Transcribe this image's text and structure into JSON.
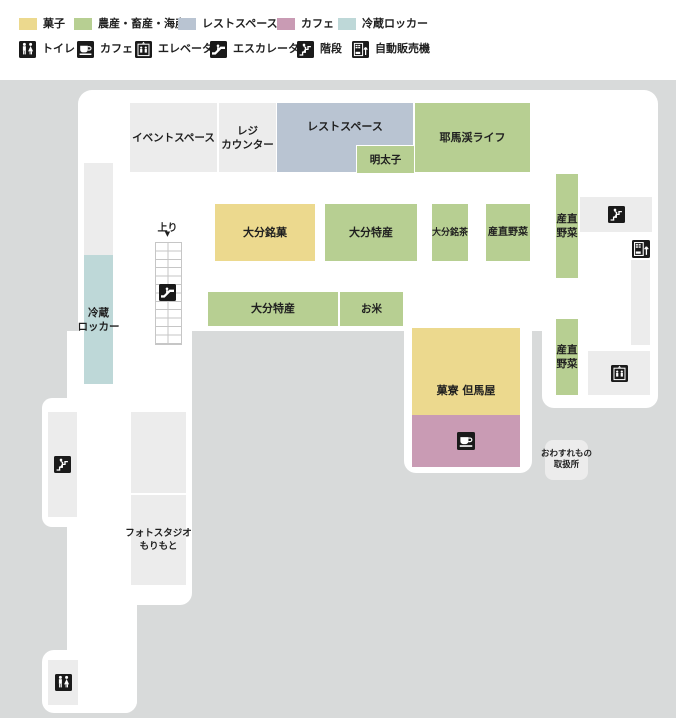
{
  "colors": {
    "bg_gray": "#d8dada",
    "floor_white": "#ffffff",
    "box_light": "#ececec",
    "sweets_yellow": "#ecd98e",
    "produce_green": "#b7cf92",
    "rest_blue": "#b9c4d2",
    "cafe_pink": "#c99bb4",
    "locker_teal": "#bed8d8",
    "icon_black": "#1a1a1a",
    "text": "#1f1f1f"
  },
  "legend": {
    "categories": [
      {
        "label": "菓子",
        "color": "sweets_yellow"
      },
      {
        "label": "農産・畜産・海産",
        "color": "produce_green"
      },
      {
        "label": "レストスペース",
        "color": "rest_blue"
      },
      {
        "label": "カフェ",
        "color": "cafe_pink"
      },
      {
        "label": "冷蔵ロッカー",
        "color": "locker_teal"
      }
    ],
    "facilities": [
      {
        "label": "トイレ",
        "icon": "toilet-icon"
      },
      {
        "label": "カフェ",
        "icon": "cafe-icon"
      },
      {
        "label": "エレベータ",
        "icon": "elevator-icon"
      },
      {
        "label": "エスカレータ",
        "icon": "escalator-icon"
      },
      {
        "label": "階段",
        "icon": "stairs-icon"
      },
      {
        "label": "自動販売機",
        "icon": "vending-icon"
      }
    ]
  },
  "map": {
    "booths": [
      {
        "id": "event-space",
        "label": "イベントスペース"
      },
      {
        "id": "register-counter",
        "lines": [
          "レジ",
          "カウンター"
        ]
      },
      {
        "id": "rest-space",
        "label": "レストスペース"
      },
      {
        "id": "mentaiko",
        "label": "明太子"
      },
      {
        "id": "yabakei-life",
        "label": "耶馬渓ライフ"
      },
      {
        "id": "oita-meika",
        "label": "大分銘菓"
      },
      {
        "id": "oita-tokusan-1",
        "label": "大分特産"
      },
      {
        "id": "oita-meicha",
        "label": "大分銘茶"
      },
      {
        "id": "sanchoku-yasai-mid",
        "label": "産直野菜"
      },
      {
        "id": "sanchoku-yasai-right-1",
        "lines": [
          "産直",
          "野菜"
        ]
      },
      {
        "id": "oita-tokusan-2",
        "label": "大分特産"
      },
      {
        "id": "okome",
        "label": "お米"
      },
      {
        "id": "karyo-tajimaya",
        "label": "菓寮 但馬屋"
      },
      {
        "id": "cafe-space",
        "icon": "cafe-icon"
      },
      {
        "id": "sanchoku-yasai-right-2",
        "lines": [
          "産直",
          "野菜"
        ]
      },
      {
        "id": "reizo-locker",
        "lines": [
          "冷蔵",
          "ロッカー"
        ]
      },
      {
        "id": "photo-studio",
        "lines": [
          "フォトスタジオ",
          "もりもと"
        ]
      },
      {
        "id": "lost-and-found",
        "lines": [
          "おわすれもの",
          "取扱所"
        ]
      }
    ],
    "escalator": {
      "label": "上り",
      "arrow": "▼"
    }
  }
}
